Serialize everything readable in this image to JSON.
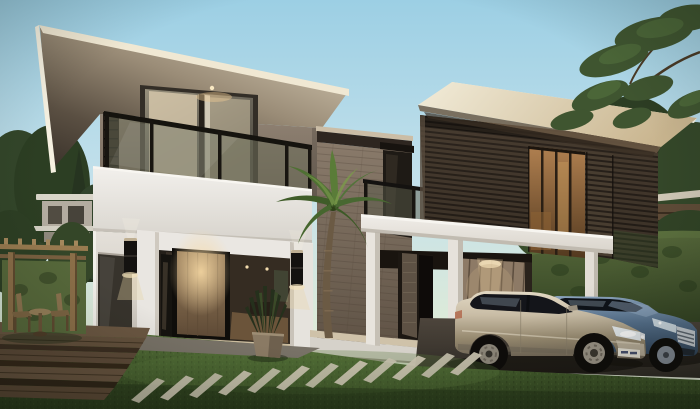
{
  "scene": {
    "description": "Dusk architectural rendering of a modern two-storey tropical house: white pavilion with overhanging cream roof and glass balcony, stone core with palm tree, dark wood-slat pavilion over a white carport with two sedans, pergola, hedges, stepping stones and lawn",
    "time_of_day": "dusk",
    "objects": [
      "sky",
      "left-pavilion",
      "roof",
      "balcony",
      "entrance-door",
      "wall-sconces",
      "stone-tower",
      "palm-tree",
      "right-pavilion",
      "louver-screens",
      "carport",
      "garage-door",
      "hedge",
      "sedan-silver",
      "sedan-blue",
      "driveway",
      "lawn",
      "stepping-stones",
      "deck-steps",
      "pergola",
      "patio-furniture",
      "background-trees",
      "neighbor-houses"
    ]
  },
  "palette": {
    "sky_top": "#9ccfe4",
    "sky_mid": "#c4e1eb",
    "sky_horizon": "#e9ecd9",
    "roof_cream": "#f0e8d3",
    "soffit_dark": "#3a322a",
    "wall_taupe": "#908273",
    "wall_white": "#e4e0d9",
    "parapet_white": "#f2f0ec",
    "balcony_glass": "#6c6e5a",
    "curtain": "#d8c9ad",
    "door_wood": "#9a7f5c",
    "warm_light": "#f0d3a0",
    "sconce_black": "#141210",
    "stone_tile": "#a2917f",
    "slat_wood": "#453a2f",
    "window_glow": "#b08050",
    "louver_wood": "#453a2d",
    "band_white": "#f0ede8",
    "carport_ceiling": "#19140f",
    "garage_door": "#8d7a66",
    "hedge_green": "#57693b",
    "tree_dark": "#3f5530",
    "tree_light": "#567540",
    "palm_green": "#5a7c38",
    "trunk_brown": "#6b5a44",
    "grass_light": "#5d7840",
    "grass_dark": "#2c3e1c",
    "paver_stone": "#c8c2ae",
    "deck_wood": "#63503c",
    "pergola_wood": "#8c6f49",
    "driveway": "#4d453c",
    "car_silver": "#e3d9c4",
    "car_silver_dark": "#6e6455",
    "car_blue": "#8aa3bd",
    "car_blue_dark": "#2e4258",
    "window_dark": "#14151a"
  }
}
